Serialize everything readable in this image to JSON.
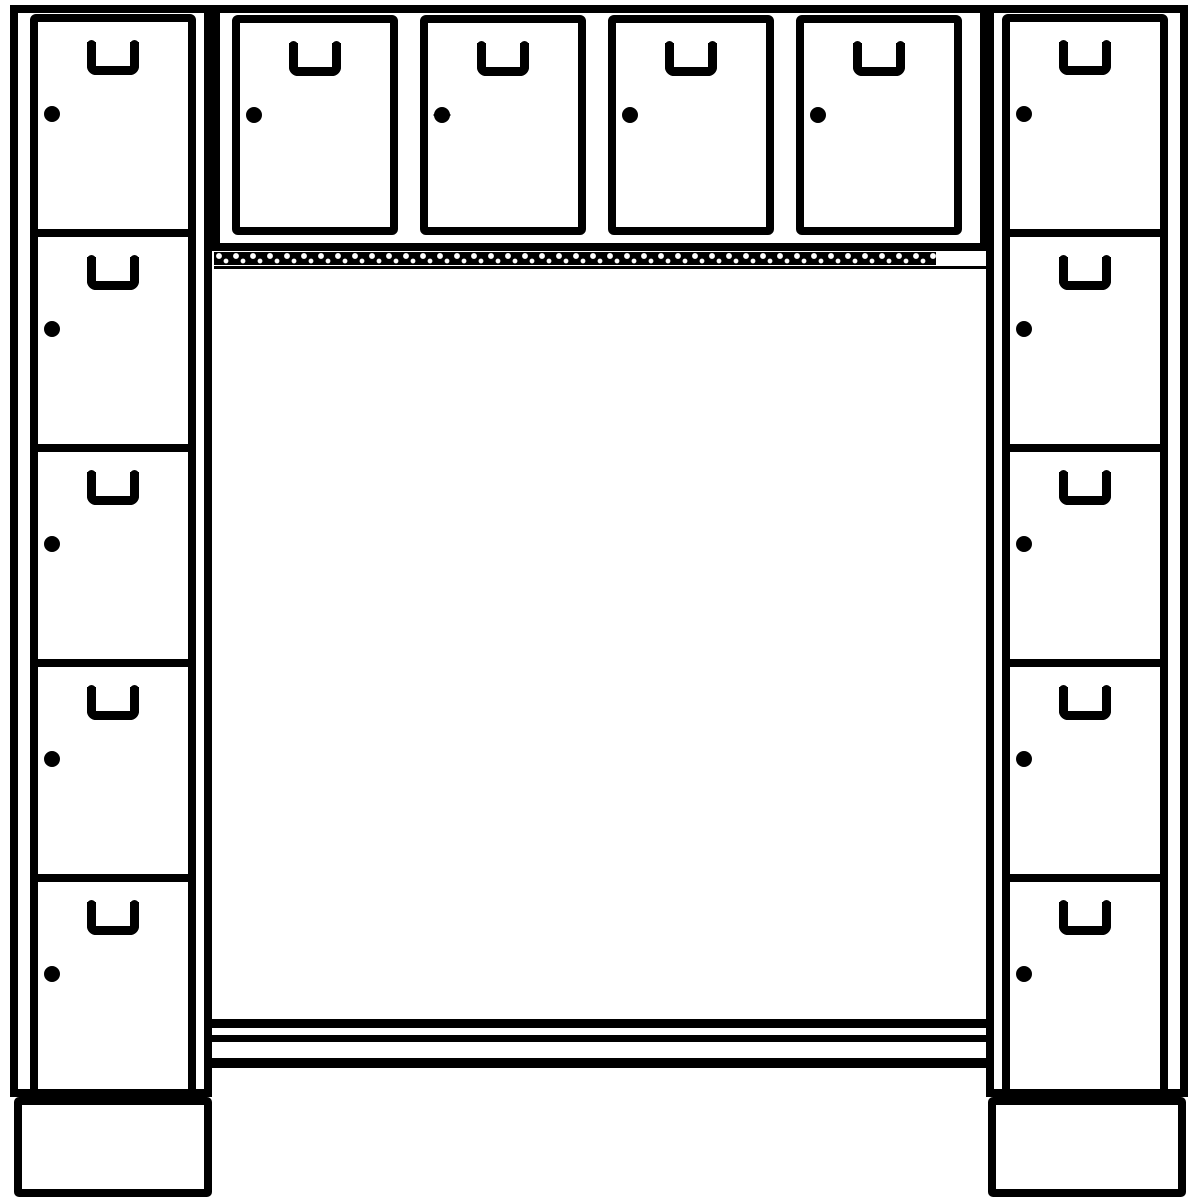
{
  "image": {
    "description": "Black-and-white technical line drawing of a cloakroom locker unit: two five-compartment locker columns flanking an open central bay, four overhead lockers across the top, a coat-hook rail below them and a bench with rails at the bottom, all standing on plinth bases",
    "background_color": "#ffffff",
    "stroke_color": "#000000"
  },
  "left_column": {
    "compartments": 5
  },
  "right_column": {
    "compartments": 5
  },
  "overhead_row": {
    "lockers": 4,
    "rosette_lock_index": 1
  },
  "central_bay": {
    "hook_rail": "coat hook rail strip with repeated hooks",
    "hooks_approx": 42,
    "bench_rails": 3
  },
  "plinth_bases": 2,
  "door_furniture": {
    "handle": "recessed grip handle",
    "lock": "cam lock",
    "rosette_lock": "rosette cam lock"
  }
}
